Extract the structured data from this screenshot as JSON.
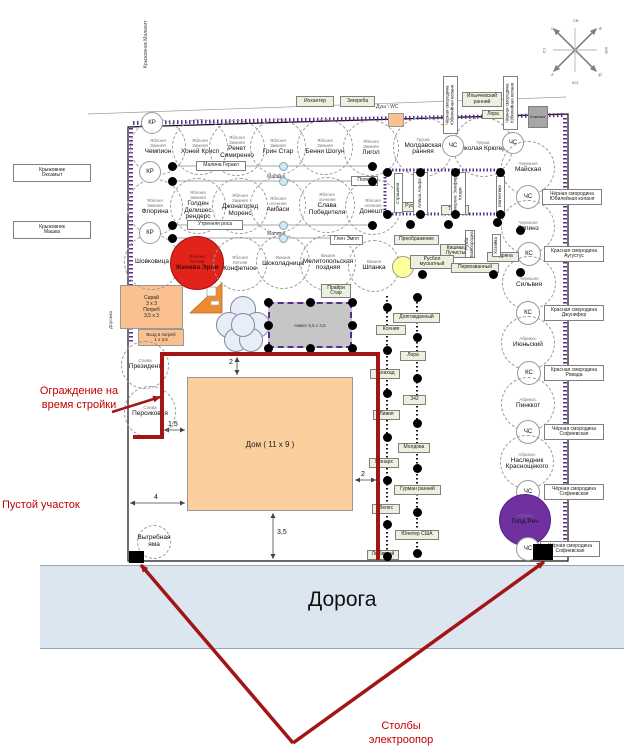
{
  "colors": {
    "road_fill": "#dce6f1",
    "fence_red": "#a31515",
    "annotation_red": "#c00000",
    "hatch_purple": "#5b2b8f",
    "apple_red": "#e2231a",
    "apricot_purple": "#7030a0",
    "house_orange": "#fbce9e",
    "shed_orange": "#fac08f",
    "canopy_gray": "#c6c6c6",
    "label_green": "#ebf1de",
    "raspberry_blue": "#cfe8f3",
    "yellow_circle": "#ffff9c"
  },
  "road": {
    "label": "Дорога"
  },
  "house": {
    "label": "Дом ( 11 x 9 )"
  },
  "shed": {
    "label": "Сарай\n3 х 3\nПогреб\n3,5 х 3"
  },
  "cellar": {
    "label": "Вход в погреб\n1 х 3,5"
  },
  "canopy": {
    "label": "Навес 5,5 х 3,5"
  },
  "annotations": {
    "fence": "Ограждение на время стройки",
    "empty": "Пустой участок",
    "poles": "Столбы электроопор"
  },
  "circles": [
    {
      "x": 158,
      "y": 147,
      "r": 28,
      "cls": "t",
      "top": "Яблоня\nЗимняя",
      "name": "Чемпион"
    },
    {
      "x": 200,
      "y": 147,
      "r": 28,
      "cls": "t",
      "top": "Яблоня\nЗимняя",
      "name": "Хоней Крисп"
    },
    {
      "x": 237,
      "y": 148,
      "r": 28,
      "cls": "t",
      "top": "Яблоня\nЗимняя",
      "name": "Ренет Симиренко"
    },
    {
      "x": 278,
      "y": 147,
      "r": 28,
      "cls": "t",
      "top": "Яблоня\nЗимняя",
      "name": "Грин Стар"
    },
    {
      "x": 325,
      "y": 147,
      "r": 28,
      "cls": "t",
      "top": "Яблоня\nЗимняя",
      "name": "Бенни Шогун"
    },
    {
      "x": 371,
      "y": 148,
      "r": 28,
      "cls": "t",
      "top": "Яблоня\nЗимняя",
      "name": "Лигол"
    },
    {
      "x": 423,
      "y": 147,
      "r": 30,
      "cls": "t",
      "top": "Груша",
      "name": "Молдавская ранняя"
    },
    {
      "x": 483,
      "y": 147,
      "r": 30,
      "cls": "t",
      "top": "Груша",
      "name": "Николая Крюгера"
    },
    {
      "x": 155,
      "y": 207,
      "r": 28,
      "cls": "t",
      "top": "Яблоня\nЗимняя",
      "name": "Флорина"
    },
    {
      "x": 198,
      "y": 206,
      "r": 28,
      "cls": "t",
      "top": "Яблоня\nЗимняя",
      "name": "Голден Делишес рендерс"
    },
    {
      "x": 240,
      "y": 206,
      "r": 28,
      "cls": "t",
      "top": "Яблоня\nЗимняя",
      "name": "Джонагоред Моренс"
    },
    {
      "x": 278,
      "y": 205,
      "r": 28,
      "cls": "t",
      "top": "Яблоня\nосенняя",
      "name": "Амбаси"
    },
    {
      "x": 327,
      "y": 205,
      "r": 28,
      "cls": "t",
      "top": "Яблоня\nосенняя",
      "name": "Слава Победителя"
    },
    {
      "x": 373,
      "y": 207,
      "r": 28,
      "cls": "t",
      "top": "Яблоня\nосенняя",
      "name": "Донешта"
    },
    {
      "x": 152,
      "y": 262,
      "r": 28,
      "cls": "t",
      "top": "",
      "name": "Шовковица"
    },
    {
      "x": 197,
      "y": 263,
      "r": 27,
      "cls": "red",
      "top": "Яблоня\nЛетняя",
      "name": "Женева Эрли"
    },
    {
      "x": 240,
      "y": 264,
      "r": 27,
      "cls": "t",
      "top": "Яблоня\nЛетняя",
      "name": "Конфетное"
    },
    {
      "x": 283,
      "y": 262,
      "r": 27,
      "cls": "t",
      "top": "Вишня",
      "name": "Шоколадница"
    },
    {
      "x": 328,
      "y": 263,
      "r": 28,
      "cls": "t",
      "top": "Вишня",
      "name": "Мелитопольская поздняя"
    },
    {
      "x": 374,
      "y": 266,
      "r": 26,
      "cls": "t",
      "top": "Вишня",
      "name": "Шпанка"
    },
    {
      "x": 152,
      "y": 123,
      "r": 11,
      "cls": "s",
      "top": "",
      "name": "КР"
    },
    {
      "x": 150,
      "y": 172,
      "r": 11,
      "cls": "s",
      "top": "",
      "name": "КР"
    },
    {
      "x": 150,
      "y": 233,
      "r": 11,
      "cls": "s",
      "top": "",
      "name": "КР"
    },
    {
      "x": 145,
      "y": 365,
      "r": 24,
      "cls": "t",
      "top": "Слива",
      "name": "Президент"
    },
    {
      "x": 150,
      "y": 412,
      "r": 26,
      "cls": "t",
      "top": "Слива",
      "name": "Персиковая"
    },
    {
      "x": 453,
      "y": 146,
      "r": 11,
      "cls": "s",
      "top": "",
      "name": "ЧС"
    },
    {
      "x": 513,
      "y": 143,
      "r": 11,
      "cls": "s",
      "top": "",
      "name": "ЧС"
    },
    {
      "x": 528,
      "y": 168,
      "r": 27,
      "cls": "t",
      "top": "Черешня",
      "name": "Майская"
    },
    {
      "x": 528,
      "y": 197,
      "r": 12,
      "cls": "s",
      "top": "",
      "name": "ЧС"
    },
    {
      "x": 528,
      "y": 227,
      "r": 27,
      "cls": "t",
      "top": "Черешня",
      "name": "Ляпинз"
    },
    {
      "x": 529,
      "y": 254,
      "r": 12,
      "cls": "s",
      "top": "",
      "name": "КС"
    },
    {
      "x": 529,
      "y": 283,
      "r": 27,
      "cls": "t",
      "top": "Черешня",
      "name": "Сильвия"
    },
    {
      "x": 528,
      "y": 313,
      "r": 12,
      "cls": "s",
      "top": "",
      "name": "КС"
    },
    {
      "x": 528,
      "y": 343,
      "r": 27,
      "cls": "t",
      "top": "Абрикос",
      "name": "Июньский"
    },
    {
      "x": 529,
      "y": 373,
      "r": 12,
      "cls": "s",
      "top": "",
      "name": "КС"
    },
    {
      "x": 528,
      "y": 404,
      "r": 27,
      "cls": "t",
      "top": "Абрикос",
      "name": "Пинккот"
    },
    {
      "x": 528,
      "y": 432,
      "r": 12,
      "cls": "s",
      "top": "",
      "name": "ЧС"
    },
    {
      "x": 527,
      "y": 462,
      "r": 27,
      "cls": "t",
      "top": "Абрикос",
      "name": "Наследник Краснощекого"
    },
    {
      "x": 528,
      "y": 492,
      "r": 12,
      "cls": "s",
      "top": "",
      "name": "ЧС"
    },
    {
      "x": 525,
      "y": 520,
      "r": 26,
      "cls": "purple",
      "top": "Абрикос",
      "name": "Голд Рич"
    },
    {
      "x": 528,
      "y": 549,
      "r": 12,
      "cls": "s",
      "top": "",
      "name": "ЧС"
    },
    {
      "x": 154,
      "y": 542,
      "r": 17,
      "cls": "t",
      "top": "",
      "name": "Выгребная яма"
    },
    {
      "x": 403,
      "y": 267,
      "r": 11,
      "cls": "yellow",
      "top": "",
      "name": ""
    }
  ],
  "boxes": [
    {
      "t": "Иохантер",
      "x": 296,
      "y": 96,
      "w": 38,
      "h": 11,
      "cls": "g"
    },
    {
      "t": "Зигереба",
      "x": 340,
      "y": 96,
      "w": 35,
      "h": 11,
      "cls": "g"
    },
    {
      "t": "Ильичевский\nранний",
      "x": 462,
      "y": 92,
      "w": 40,
      "h": 15,
      "cls": "g"
    },
    {
      "t": "Лора",
      "x": 482,
      "y": 110,
      "w": 22,
      "h": 9,
      "cls": "g"
    },
    {
      "t": "Компост",
      "x": 528,
      "y": 106,
      "w": 20,
      "h": 22,
      "cls": "gray"
    },
    {
      "t": "Малина Геракл",
      "x": 196,
      "y": 161,
      "w": 50,
      "h": 10,
      "cls": "w"
    },
    {
      "t": "Полка",
      "x": 351,
      "y": 176,
      "w": 27,
      "h": 10,
      "cls": "w"
    },
    {
      "t": "Утренняя роса",
      "x": 187,
      "y": 220,
      "w": 56,
      "h": 10,
      "cls": "w"
    },
    {
      "t": "Глен Эмпл",
      "x": 330,
      "y": 235,
      "w": 33,
      "h": 10,
      "cls": "w"
    },
    {
      "t": "Прайри\nСтар",
      "x": 321,
      "y": 284,
      "w": 30,
      "h": 14,
      "cls": "g"
    },
    {
      "t": "Руслан",
      "x": 399,
      "y": 202,
      "w": 29,
      "h": 10,
      "cls": "g"
    },
    {
      "t": "Тимур",
      "x": 441,
      "y": 205,
      "w": 28,
      "h": 10,
      "cls": "g"
    },
    {
      "t": "Преображение",
      "x": 394,
      "y": 235,
      "w": 45,
      "h": 10,
      "cls": "g"
    },
    {
      "t": "Кишмыш\nЛучистый",
      "x": 440,
      "y": 244,
      "w": 34,
      "h": 14,
      "cls": "g"
    },
    {
      "t": "Русбол\nмускатный",
      "x": 410,
      "y": 255,
      "w": 44,
      "h": 14,
      "cls": "g"
    },
    {
      "t": "Первозванный",
      "x": 451,
      "y": 263,
      "w": 48,
      "h": 10,
      "cls": "g"
    },
    {
      "t": "Кодряна",
      "x": 487,
      "y": 252,
      "w": 32,
      "h": 10,
      "cls": "g"
    },
    {
      "t": "Ксения",
      "x": 376,
      "y": 325,
      "w": 30,
      "h": 10,
      "cls": "g"
    },
    {
      "t": "Галахад",
      "x": 370,
      "y": 369,
      "w": 30,
      "h": 10,
      "cls": "g"
    },
    {
      "t": "Ливия",
      "x": 373,
      "y": 410,
      "w": 27,
      "h": 10,
      "cls": "g"
    },
    {
      "t": "Монарх",
      "x": 369,
      "y": 458,
      "w": 30,
      "h": 10,
      "cls": "g"
    },
    {
      "t": "Велес",
      "x": 372,
      "y": 504,
      "w": 28,
      "h": 10,
      "cls": "g"
    },
    {
      "t": "Любимый",
      "x": 367,
      "y": 550,
      "w": 32,
      "h": 10,
      "cls": "g"
    },
    {
      "t": "Долгожданный",
      "x": 393,
      "y": 313,
      "w": 47,
      "h": 10,
      "cls": "g"
    },
    {
      "t": "Лора",
      "x": 400,
      "y": 351,
      "w": 26,
      "h": 10,
      "cls": "g"
    },
    {
      "t": "342",
      "x": 403,
      "y": 395,
      "w": 23,
      "h": 10,
      "cls": "g"
    },
    {
      "t": "Молдова",
      "x": 398,
      "y": 443,
      "w": 32,
      "h": 10,
      "cls": "g"
    },
    {
      "t": "Гурман ранний",
      "x": 394,
      "y": 485,
      "w": 47,
      "h": 10,
      "cls": "g"
    },
    {
      "t": "Юпитер США",
      "x": 395,
      "y": 530,
      "w": 44,
      "h": 10,
      "cls": "g"
    },
    {
      "t": "Чёрная смородина\nЮбилейная копаня",
      "x": 542,
      "y": 189,
      "w": 60,
      "h": 16,
      "cls": "w"
    },
    {
      "t": "Красная смородина\nАугустус",
      "x": 544,
      "y": 246,
      "w": 60,
      "h": 16,
      "cls": "w"
    },
    {
      "t": "Красная смородина\nДжунифер",
      "x": 544,
      "y": 305,
      "w": 60,
      "h": 16,
      "cls": "w"
    },
    {
      "t": "Красная смородина\nРовада",
      "x": 544,
      "y": 365,
      "w": 60,
      "h": 16,
      "cls": "w"
    },
    {
      "t": "Чёрная смородина\nСофиевская",
      "x": 544,
      "y": 424,
      "w": 60,
      "h": 16,
      "cls": "w"
    },
    {
      "t": "Чёрная смородина\nСофиевская",
      "x": 544,
      "y": 484,
      "w": 60,
      "h": 16,
      "cls": "w"
    },
    {
      "t": "Чёрная смородина\nСофиевская",
      "x": 540,
      "y": 541,
      "w": 60,
      "h": 16,
      "cls": "w"
    },
    {
      "t": "Крыжовник\nОксамыт",
      "x": 13,
      "y": 164,
      "w": 78,
      "h": 18,
      "cls": "w"
    },
    {
      "t": "Крыжовник\nМашка",
      "x": 13,
      "y": 221,
      "w": 78,
      "h": 18,
      "cls": "w"
    },
    {
      "t": "Крыжовник Малахит",
      "x": 138,
      "y": 12,
      "w": 17,
      "h": 64,
      "cls": "vplain"
    },
    {
      "t": "Чёрная смородина Юбилейная копаня",
      "x": 443,
      "y": 76,
      "w": 15,
      "h": 58,
      "cls": "vw"
    },
    {
      "t": "Чёрная смородина Юбилейная копаня",
      "x": 503,
      "y": 76,
      "w": 15,
      "h": 54,
      "cls": "vw"
    },
    {
      "t": "Страшена",
      "x": 394,
      "y": 173,
      "w": 9,
      "h": 40,
      "cls": "vw"
    },
    {
      "t": "Алёша Альфа",
      "x": 413,
      "y": 172,
      "w": 15,
      "h": 43,
      "cls": "vw"
    },
    {
      "t": "Фиоренс Земфира Клэри",
      "x": 451,
      "y": 172,
      "w": 15,
      "h": 43,
      "cls": "vw"
    },
    {
      "t": "Магнетика",
      "x": 496,
      "y": 176,
      "w": 9,
      "h": 40,
      "cls": "vw"
    },
    {
      "t": "Рузба Байбородна",
      "x": 465,
      "y": 230,
      "w": 10,
      "h": 28,
      "cls": "vw"
    },
    {
      "t": "Хозяйка",
      "x": 492,
      "y": 234,
      "w": 9,
      "h": 23,
      "cls": "vw"
    }
  ],
  "texts": [
    {
      "t": "Душ \\ WC",
      "x": 376,
      "y": 104,
      "cls": "tiny"
    },
    {
      "t": "Малина",
      "x": 267,
      "y": 174,
      "cls": "tiny"
    },
    {
      "t": "Малина",
      "x": 267,
      "y": 231,
      "cls": "tiny"
    },
    {
      "t": "Дорожка",
      "x": 108,
      "y": 287,
      "h": 42,
      "cls": "vtiny"
    },
    {
      "t": "2",
      "x": 229,
      "y": 359,
      "cls": "dim"
    },
    {
      "t": "1,5",
      "x": 168,
      "y": 421,
      "cls": "dim"
    },
    {
      "t": "4",
      "x": 154,
      "y": 494,
      "cls": "dim"
    },
    {
      "t": "2",
      "x": 361,
      "y": 471,
      "cls": "dim"
    },
    {
      "t": "3,5",
      "x": 277,
      "y": 529,
      "cls": "dim"
    },
    {
      "t": "С",
      "x": 551,
      "y": 26,
      "cls": "compass",
      "rot": -45
    },
    {
      "t": "В",
      "x": 599,
      "y": 26,
      "cls": "compass",
      "rot": 45
    },
    {
      "t": "Ю",
      "x": 598,
      "y": 72,
      "cls": "compass",
      "rot": -45
    },
    {
      "t": "З",
      "x": 551,
      "y": 72,
      "cls": "compass",
      "rot": 45
    },
    {
      "t": "СВ",
      "x": 573,
      "y": 18,
      "cls": "compass",
      "rot": 0
    },
    {
      "t": "ЮВ",
      "x": 603,
      "y": 48,
      "cls": "compass",
      "rot": 90
    },
    {
      "t": "ЮЗ",
      "x": 572,
      "y": 80,
      "cls": "compass",
      "rot": 0
    },
    {
      "t": "СЗ",
      "x": 542,
      "y": 48,
      "cls": "compass",
      "rot": 90
    }
  ],
  "dots": [
    [
      172,
      166
    ],
    [
      372,
      166
    ],
    [
      172,
      181
    ],
    [
      372,
      181
    ],
    [
      172,
      225
    ],
    [
      372,
      225
    ],
    [
      172,
      238
    ],
    [
      387,
      172
    ],
    [
      420,
      172
    ],
    [
      455,
      172
    ],
    [
      500,
      172
    ],
    [
      387,
      214
    ],
    [
      420,
      214
    ],
    [
      455,
      214
    ],
    [
      500,
      214
    ],
    [
      410,
      224
    ],
    [
      448,
      224
    ],
    [
      497,
      222
    ],
    [
      520,
      230
    ],
    [
      422,
      274
    ],
    [
      493,
      274
    ],
    [
      520,
      272
    ],
    [
      268,
      302
    ],
    [
      310,
      302
    ],
    [
      352,
      302
    ],
    [
      268,
      348
    ],
    [
      310,
      348
    ],
    [
      352,
      348
    ],
    [
      268,
      325
    ],
    [
      352,
      325
    ],
    [
      387,
      307
    ],
    [
      387,
      350
    ],
    [
      387,
      393
    ],
    [
      387,
      437
    ],
    [
      387,
      480
    ],
    [
      387,
      524
    ],
    [
      387,
      556
    ],
    [
      417,
      297
    ],
    [
      417,
      337
    ],
    [
      417,
      378
    ],
    [
      417,
      423
    ],
    [
      417,
      468
    ],
    [
      417,
      512
    ],
    [
      417,
      553
    ]
  ],
  "light_dots": [
    [
      283,
      166
    ],
    [
      283,
      181
    ],
    [
      283,
      225
    ],
    [
      283,
      238
    ]
  ]
}
